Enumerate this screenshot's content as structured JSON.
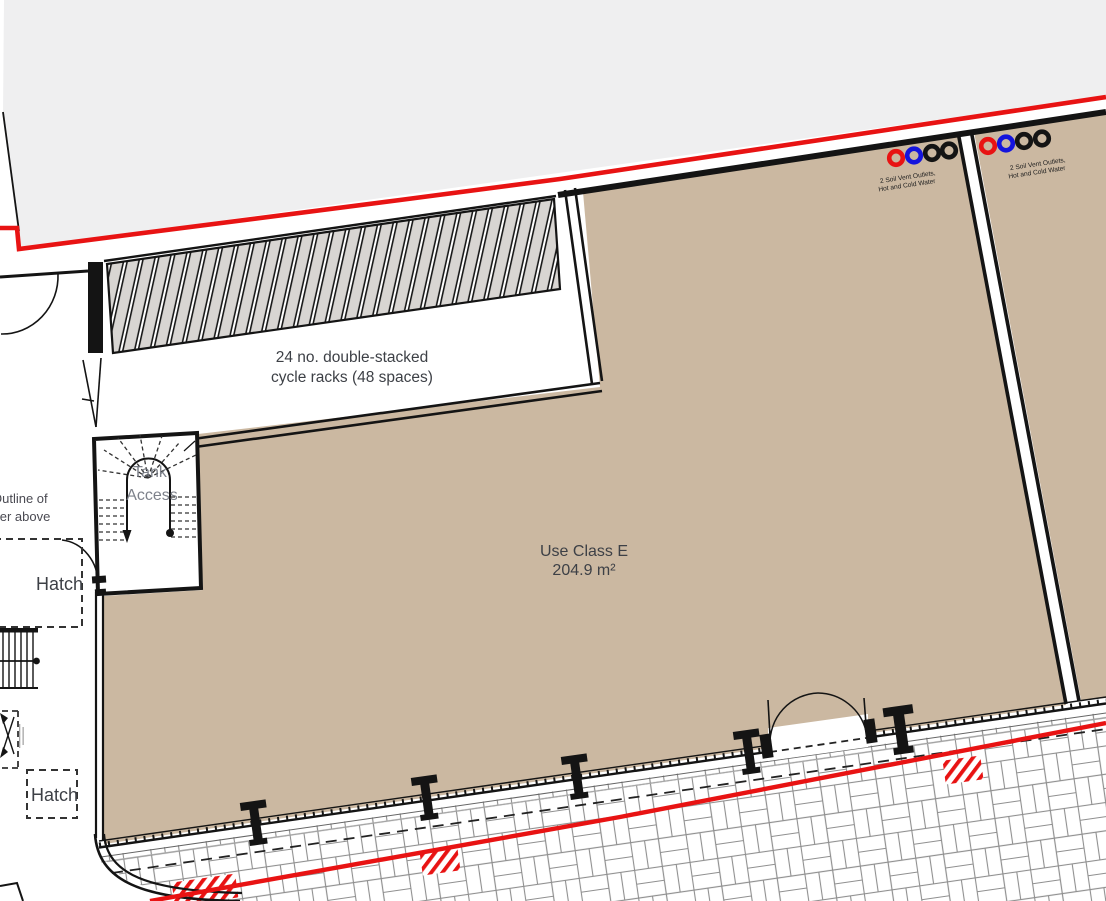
{
  "document": {
    "kind": "architectural-ground-floor-plan-detail"
  },
  "labels": {
    "cycle_racks_line1": "24 no. double-stacked",
    "cycle_racks_line2": "cycle racks (48 spaces)",
    "unit_use_class": "Use Class E",
    "unit_area": "204.9 m²",
    "riser_line1": "Outline of",
    "riser_line2": "riser above",
    "hatch_upper": "Hatch",
    "hatch_lower": "Hatch",
    "tank_line1": "Tank",
    "tank_line2": "Access",
    "soil_vent_line1": "2 Soil Vent Outlets,",
    "soil_vent_line2": "Hot and Cold Water"
  },
  "colors": {
    "site_boundary_red": "#e81313",
    "unit_floor_tan": "#cbb8a1",
    "adjacent_surface_grey": "#efeff0",
    "cycle_rack_stripe_grey": "#d8d5d2",
    "wall_black": "#141414",
    "paving_joint_grey": "#8f8f8f",
    "label_text": "#3d4046",
    "tank_text_grey": "#6f747e",
    "soil_vent_dot_colors": [
      "#e81313",
      "#1414dd",
      "#141414",
      "#141414"
    ]
  }
}
